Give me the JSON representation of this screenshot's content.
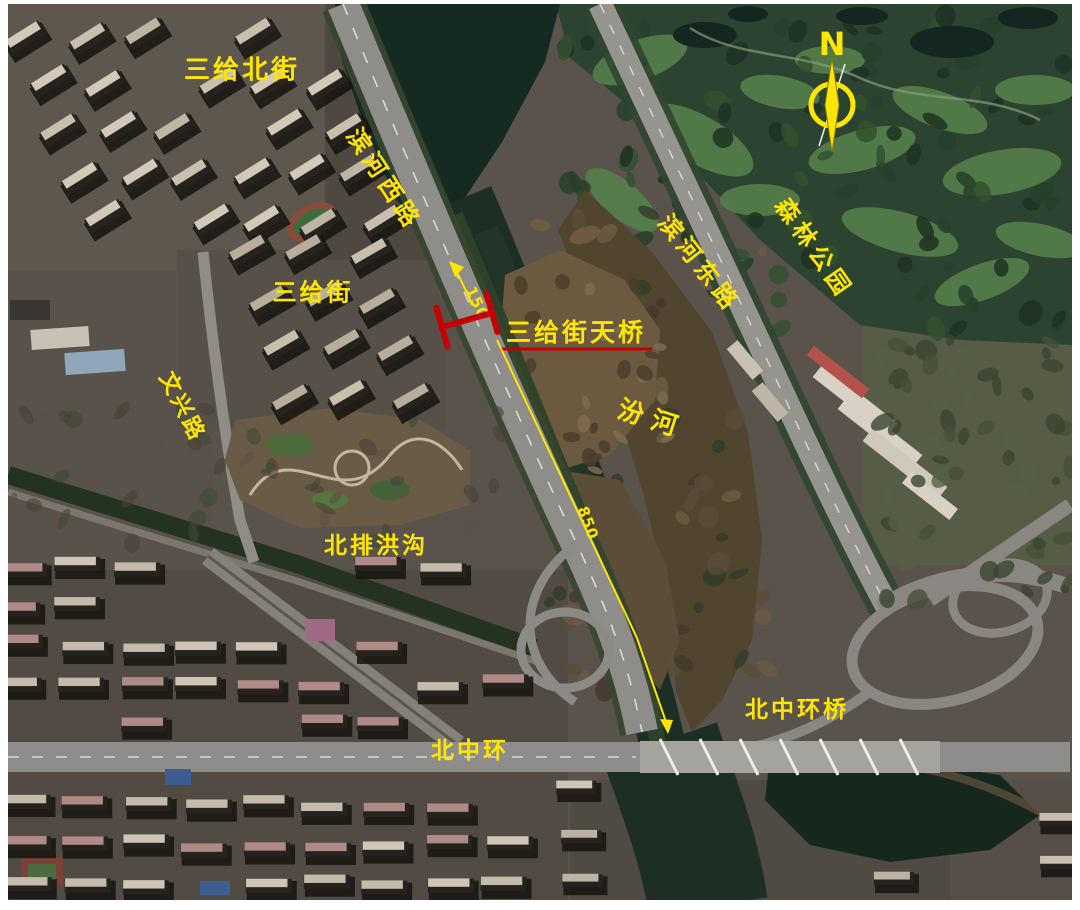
{
  "map": {
    "kind": "satellite-bridge-location-map",
    "colors": {
      "label_yellow": "#ffe600",
      "marker_red": "#bf0000"
    },
    "road_labels": {
      "sanji_north_street": "三给北街",
      "binhe_west_road": "滨河西路",
      "sanji_street": "三给街",
      "wenxing_road": "文兴路",
      "north_drainage_ditch": "北排洪沟",
      "north_middle_ring_road": "北中环",
      "north_middle_ring_bridge": "北中环桥",
      "binhe_east_road": "滨河东路"
    },
    "place_labels": {
      "forest_park": "森林公园",
      "fen_river_char_1": "汾",
      "fen_river_char_2": "河"
    },
    "site": {
      "name": "三给街天桥"
    },
    "north_indicator": {
      "letter": "N"
    },
    "distance_annotations": {
      "upper": "150",
      "lower": "850"
    }
  }
}
